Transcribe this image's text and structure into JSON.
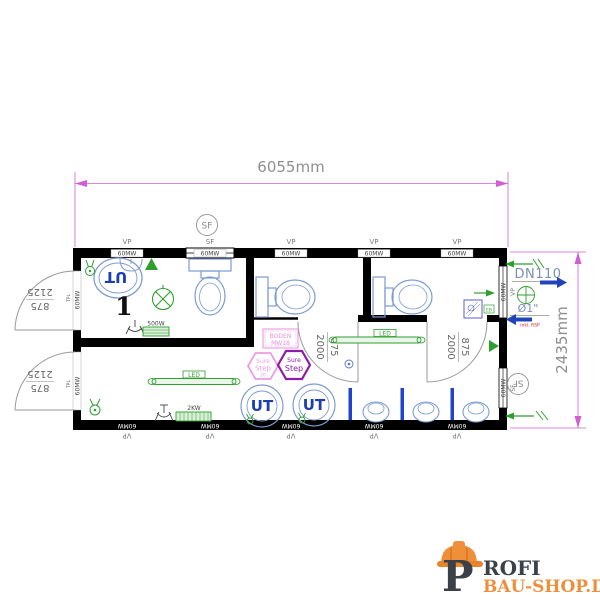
{
  "colors": {
    "wall": "#000000",
    "dimension_line": "#cf5fd3",
    "dimension_text": "#8f8f8f",
    "fixture_blue": "#7d9bd1",
    "ut_text_blue": "#1d3fae",
    "divider_blue": "#2244cc",
    "flow_arrow_blue": "#2244bb",
    "symbol_green": "#2f9e2f",
    "heater_green_fill": "#d9efd9",
    "floor_pink": "#e98fdc",
    "step_purple": "#8d1ca8",
    "note_red": "#cc2222",
    "logo_dark": "#3b4148",
    "logo_orange": "#ef8f3c"
  },
  "dimensions": {
    "overall_width": "6055mm",
    "overall_height": "2435mm",
    "ext_door_width": "875",
    "ext_door_height": "2125",
    "int_door_width": "875",
    "int_door_height": "2000"
  },
  "labels": {
    "vp": "VP",
    "sf": "SF",
    "mw": "60MW",
    "tpl": "TPL",
    "ut": "UT",
    "room_number": "1",
    "led": "LED",
    "heater_500w": "500W",
    "heater_2kw": "2KW",
    "drain_pipe": "DN110",
    "water_pipe": "Ø1\"",
    "water_note": "inkl. RSP",
    "floor_line1": "BODEN",
    "floor_line2": "MW18",
    "sure": "Sure",
    "step": "Step",
    "step_num": "20",
    "boiler_tag": "EB"
  },
  "logo": {
    "initial": "P",
    "name": "ROFI",
    "domain": "BAU-SHOP.DE"
  }
}
